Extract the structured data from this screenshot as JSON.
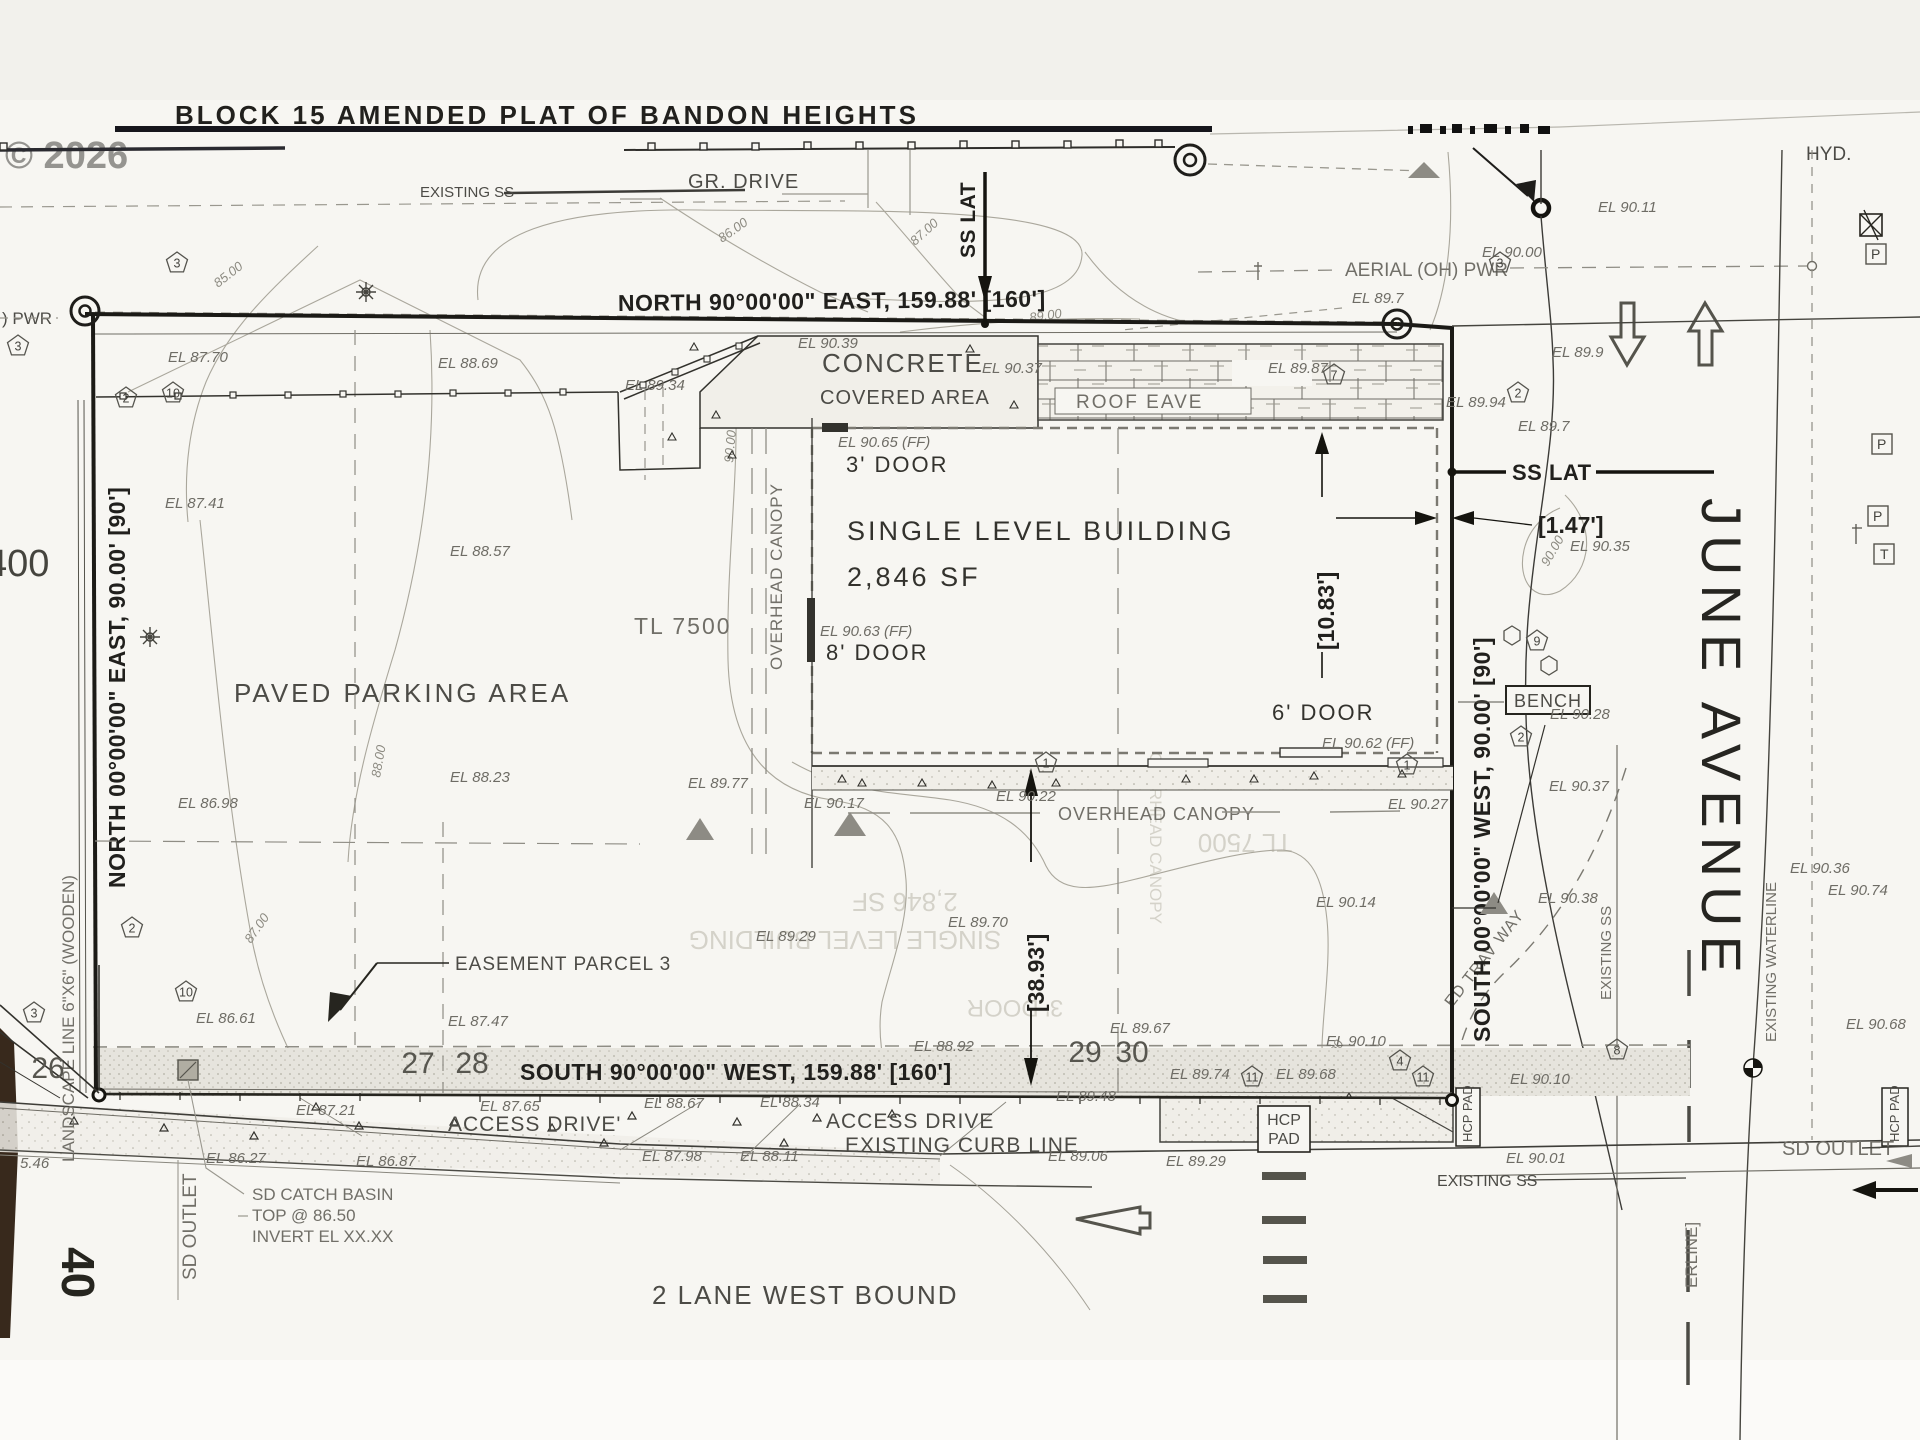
{
  "watermark": "© 2026",
  "title": "BLOCK 15 AMENDED PLAT OF BANDON HEIGHTS",
  "texts": {
    "gr_drive": "GR. DRIVE",
    "existing_ss_top": "EXISTING SS",
    "existing_ss_bottom": "EXISTING SS",
    "existing_ss_vert": "EXISTING SS",
    "existing_waterline": "EXISTING WATERLINE",
    "centerline_part": "ERLINE]",
    "north_bdy": "NORTH 90°00'00\" EAST, 159.88' [160']",
    "south_bdy": "SOUTH 90°00'00\" WEST, 159.88' [160']",
    "west_bdy": "NORTH 00°00'00\" EAST, 90.00' [90']",
    "east_bdy": "SOUTH 00°00'00\" WEST, 90.00' [90']",
    "landscape_line": "LANDSCAPE LINE 6\"X6\" (WOODEN)",
    "pwr_left": ") PWR",
    "aerial_pwr": "AERIAL (OH) PWR",
    "hyd": "HYD.",
    "june_avenue": "JUNE AVENUE",
    "concrete_l1": "CONCRETE",
    "concrete_l2": "COVERED AREA",
    "roof_eave": "ROOF EAVE",
    "ss_lat_vert": "SS LAT",
    "ss_lat_horz": "SS LAT",
    "dim_eave": "[10.83']",
    "dim_lat": "[1.47']",
    "dim_canopy": "[38.93']",
    "building_l1": "SINGLE LEVEL BUILDING",
    "building_l2": "2,846 SF",
    "door3": "3' DOOR",
    "door8": "8' DOOR",
    "door6": "6' DOOR",
    "ff_door3": "EL 90.65 (FF)",
    "ff_door8": "EL 90.63 (FF)",
    "ff_door6": "EL 90.62 (FF)",
    "tl7500": "TL 7500",
    "tl400": "400",
    "forty": "40",
    "paved": "PAVED PARKING AREA",
    "overhead_canopy_v": "OVERHEAD CANOPY",
    "overhead_canopy_h": "OVERHEAD CANOPY",
    "easement": "EASEMENT PARCEL 3",
    "bench": "BENCH",
    "ed_trav": "ED TRAV WAY",
    "access_left": "ACCESS DRIVE'",
    "access_right": "ACCESS DRIVE",
    "curb_line": "EXISTING CURB LINE",
    "westbound": "2 LANE WEST BOUND",
    "sd_outlet_left": "SD OUTLET",
    "sd_outlet_right": "SD OUTLET",
    "catch_l1": "SD CATCH BASIN",
    "catch_l2": "TOP @ 86.50",
    "catch_l3": "INVERT EL XX.XX",
    "hcp_l1": "HCP",
    "hcp_l2": "PAD",
    "hcp_vert": "HCP PAD",
    "p_box": "P",
    "t_box": "T"
  },
  "lot_numbers": [
    {
      "t": "26",
      "x": 48,
      "y": 1078
    },
    {
      "t": "27",
      "x": 418,
      "y": 1073
    },
    {
      "t": "28",
      "x": 472,
      "y": 1073
    },
    {
      "t": "29",
      "x": 1085,
      "y": 1062
    },
    {
      "t": "30",
      "x": 1132,
      "y": 1062
    }
  ],
  "spot_elevations": [
    {
      "t": "EL 87.70",
      "x": 168,
      "y": 362
    },
    {
      "t": "EL 88.69",
      "x": 438,
      "y": 368
    },
    {
      "t": "EL 89.34",
      "x": 625,
      "y": 390
    },
    {
      "t": "EL 90.39",
      "x": 798,
      "y": 348
    },
    {
      "t": "EL 90.37",
      "x": 982,
      "y": 373
    },
    {
      "t": "EL 89.87",
      "x": 1268,
      "y": 373
    },
    {
      "t": "EL 89.94",
      "x": 1446,
      "y": 407
    },
    {
      "t": "EL 89.7",
      "x": 1518,
      "y": 431
    },
    {
      "t": "EL 89.7",
      "x": 1352,
      "y": 303
    },
    {
      "t": "EL 90.00",
      "x": 1482,
      "y": 257
    },
    {
      "t": "EL 90.11",
      "x": 1598,
      "y": 212
    },
    {
      "t": "EL 89.9",
      "x": 1552,
      "y": 357
    },
    {
      "t": "EL 87.41",
      "x": 165,
      "y": 508
    },
    {
      "t": "EL 88.57",
      "x": 450,
      "y": 556
    },
    {
      "t": "EL 86.98",
      "x": 178,
      "y": 808
    },
    {
      "t": "EL 88.23",
      "x": 450,
      "y": 782
    },
    {
      "t": "EL 86.61",
      "x": 196,
      "y": 1023
    },
    {
      "t": "EL 87.47",
      "x": 448,
      "y": 1026
    },
    {
      "t": "EL 89.77",
      "x": 688,
      "y": 788
    },
    {
      "t": "EL 90.17",
      "x": 804,
      "y": 808
    },
    {
      "t": "EL 90.22",
      "x": 996,
      "y": 801
    },
    {
      "t": "EL 89.29",
      "x": 756,
      "y": 941
    },
    {
      "t": "EL 89.70",
      "x": 948,
      "y": 927
    },
    {
      "t": "EL 90.14",
      "x": 1316,
      "y": 907
    },
    {
      "t": "EL 89.67",
      "x": 1110,
      "y": 1033
    },
    {
      "t": "EL 90.27",
      "x": 1388,
      "y": 809
    },
    {
      "t": "EL 90.28",
      "x": 1550,
      "y": 719
    },
    {
      "t": "EL 90.37",
      "x": 1549,
      "y": 791
    },
    {
      "t": "EL 90.38",
      "x": 1538,
      "y": 903
    },
    {
      "t": "EL 90.35",
      "x": 1570,
      "y": 551
    },
    {
      "t": "EL 90.36",
      "x": 1790,
      "y": 873
    },
    {
      "t": "EL 90.74",
      "x": 1828,
      "y": 895
    },
    {
      "t": "EL 90.68",
      "x": 1846,
      "y": 1029
    },
    {
      "t": "EL 90.10",
      "x": 1326,
      "y": 1046
    },
    {
      "t": "EL 90.10",
      "x": 1510,
      "y": 1084
    },
    {
      "t": "EL 89.74",
      "x": 1170,
      "y": 1079
    },
    {
      "t": "EL 89.68",
      "x": 1276,
      "y": 1079
    },
    {
      "t": "EL 90.01",
      "x": 1506,
      "y": 1163
    },
    {
      "t": "EL 87.21",
      "x": 296,
      "y": 1115
    },
    {
      "t": "EL 87.65",
      "x": 480,
      "y": 1111
    },
    {
      "t": "EL 88.67",
      "x": 644,
      "y": 1108
    },
    {
      "t": "EL 88.34",
      "x": 760,
      "y": 1107
    },
    {
      "t": "EL 88.92",
      "x": 914,
      "y": 1051
    },
    {
      "t": "EL 87.98",
      "x": 642,
      "y": 1161
    },
    {
      "t": "EL 88.11",
      "x": 740,
      "y": 1161
    },
    {
      "t": "EL 89.48",
      "x": 1056,
      "y": 1101
    },
    {
      "t": "EL 89.06",
      "x": 1048,
      "y": 1161
    },
    {
      "t": "EL 89.29",
      "x": 1166,
      "y": 1166
    },
    {
      "t": "EL 86.27",
      "x": 206,
      "y": 1163
    },
    {
      "t": "EL 86.87",
      "x": 356,
      "y": 1166
    },
    {
      "t": "5.46",
      "x": 20,
      "y": 1168
    }
  ],
  "contour_labels": [
    {
      "t": "85.00",
      "x": 218,
      "y": 288,
      "r": -38
    },
    {
      "t": "86.00",
      "x": 722,
      "y": 243,
      "r": -35
    },
    {
      "t": "87.00",
      "x": 915,
      "y": 246,
      "r": -42
    },
    {
      "t": "89.00",
      "x": 1030,
      "y": 322,
      "r": -8
    },
    {
      "t": "88.00",
      "x": 380,
      "y": 778,
      "r": -80
    },
    {
      "t": "87.00",
      "x": 251,
      "y": 944,
      "r": -55
    },
    {
      "t": "90.00",
      "x": 733,
      "y": 463,
      "r": -85
    },
    {
      "t": "90.00",
      "x": 1548,
      "y": 567,
      "r": -60
    },
    {
      "t": "90.00",
      "x": 1330,
      "y": 1072,
      "r": -65
    }
  ],
  "pentagons": [
    {
      "n": "3",
      "x": 177,
      "y": 263
    },
    {
      "n": "3",
      "x": 18,
      "y": 346
    },
    {
      "n": "3",
      "x": 1500,
      "y": 263
    },
    {
      "n": "2",
      "x": 126,
      "y": 398
    },
    {
      "n": "10",
      "x": 173,
      "y": 393
    },
    {
      "n": "7",
      "x": 1334,
      "y": 375
    },
    {
      "n": "2",
      "x": 1518,
      "y": 393
    },
    {
      "n": "9",
      "x": 1537,
      "y": 641
    },
    {
      "n": "2",
      "x": 1521,
      "y": 737
    },
    {
      "n": "2",
      "x": 132,
      "y": 928
    },
    {
      "n": "10",
      "x": 186,
      "y": 992
    },
    {
      "n": "3",
      "x": 34,
      "y": 1013
    },
    {
      "n": "1",
      "x": 1046,
      "y": 763
    },
    {
      "n": "1",
      "x": 1407,
      "y": 765
    },
    {
      "n": "4",
      "x": 1400,
      "y": 1061
    },
    {
      "n": "11",
      "x": 1252,
      "y": 1077
    },
    {
      "n": "11",
      "x": 1423,
      "y": 1077
    },
    {
      "n": "8",
      "x": 1617,
      "y": 1050
    }
  ],
  "mirror_texts": [
    {
      "t": "2,846 SF",
      "x": 905,
      "y": 893,
      "r": 180,
      "s": 26
    },
    {
      "t": "SINGLE LEVEL BUILDING",
      "x": 845,
      "y": 931,
      "r": 180,
      "s": 26
    },
    {
      "t": "3' DOOR",
      "x": 1015,
      "y": 1000,
      "r": 180,
      "s": 24
    },
    {
      "t": "TL 7500",
      "x": 1245,
      "y": 834,
      "r": 180,
      "s": 26
    },
    {
      "t": "OVERHEAD CANOPY",
      "x": 1150,
      "y": 838,
      "r": 90,
      "s": 17
    }
  ]
}
